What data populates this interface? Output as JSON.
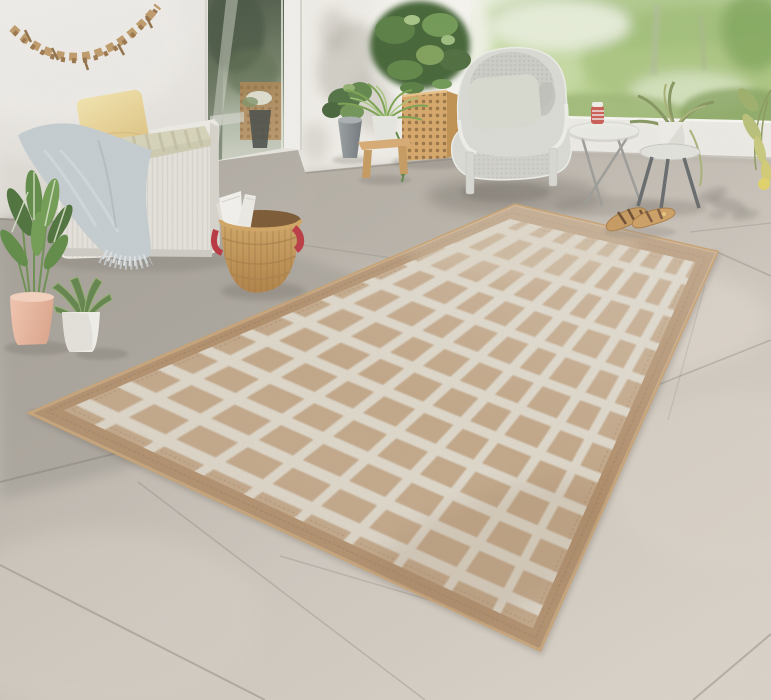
{
  "scene": {
    "description": "Sunny outdoor patio photo: beige jute rug with white diamond lattice pattern on large stone tiles, white wicker storage bench with yellow pillow and blue-gray blanket, driftwood garland on stucco wall, glass door, wooden lattice planter with shrub, gray wicker armchair, glass side table with candle jar, metal stool table with potted plant, wicker basket with papers, tan sandals, garden view behind a white ledge",
    "width": 771,
    "height": 700
  },
  "palette": {
    "wall": "#eae7e1",
    "sun_wall": "#f2f0ea",
    "floor_gray": "#a7a29a",
    "floor_light": "#d7d0c7",
    "grout": "#857f76",
    "rug_border": "#b08457",
    "rug_field": "#c7a47d",
    "rug_lattice": "#ebe4d4",
    "rug_stitch": "#8f6b49",
    "bench_white": "#e7e4de",
    "cushion_stripe": "#d8d5bb",
    "pillow_yellow": "#f0dda0",
    "blanket_blue": "#c5ced2",
    "basket_tan": "#d2a561",
    "basket_handle_red": "#bb3641",
    "paper_white": "#f5f4f0",
    "chair_gray": "#dcdcd7",
    "chair_cushion": "#d9dbd1",
    "glass_dark": "#4f5c48",
    "frame_white": "#f3f2ee",
    "garden_green": "#b7d18c",
    "planter_wood": "#d8a767",
    "stool_wood": "#d9ab72",
    "pot_pink": "#f0bca6",
    "pot_white": "#f2f1ec",
    "pot_gray": "#8d9396",
    "leaf_green": "#5d8544",
    "leaf_dark": "#3f6233",
    "ledge_white": "#efede7",
    "sandal_tan": "#c89a5e",
    "shadow": "#6f6a62"
  },
  "rug": {
    "pattern": "diamond-lattice",
    "lengthwise_lines": 9,
    "widthwise_lines": 11
  },
  "objects": [
    {
      "name": "driftwood-garland",
      "label": "driftwood garland on wall"
    },
    {
      "name": "storage-bench",
      "label": "white wicker storage bench"
    },
    {
      "name": "yellow-pillow",
      "label": "yellow cushion"
    },
    {
      "name": "seat-cushion",
      "label": "striped seat pad"
    },
    {
      "name": "blanket",
      "label": "blue-gray fringed blanket"
    },
    {
      "name": "calathea-plant",
      "label": "calathea in pink pot"
    },
    {
      "name": "aloe-plant",
      "label": "aloe in white pot"
    },
    {
      "name": "glass-door",
      "label": "glass patio door"
    },
    {
      "name": "planter-box",
      "label": "wooden lattice planter with shrub"
    },
    {
      "name": "fern-stool",
      "label": "fern on wooden step stool"
    },
    {
      "name": "gray-pot-plant",
      "label": "leafy plant in gray pot"
    },
    {
      "name": "armchair",
      "label": "gray wicker armchair"
    },
    {
      "name": "glass-table",
      "label": "glass side table with candle jar"
    },
    {
      "name": "stool-table",
      "label": "metal stool table with potted plant"
    },
    {
      "name": "white-ledge",
      "label": "white parapet ledge"
    },
    {
      "name": "garden",
      "label": "sunlit garden view"
    },
    {
      "name": "rug",
      "label": "jute rug with white diamond lattice"
    },
    {
      "name": "basket",
      "label": "wicker basket with red handles and papers"
    },
    {
      "name": "sandals",
      "label": "pair of tan sandals"
    },
    {
      "name": "tile-floor",
      "label": "large stone tile floor"
    }
  ]
}
